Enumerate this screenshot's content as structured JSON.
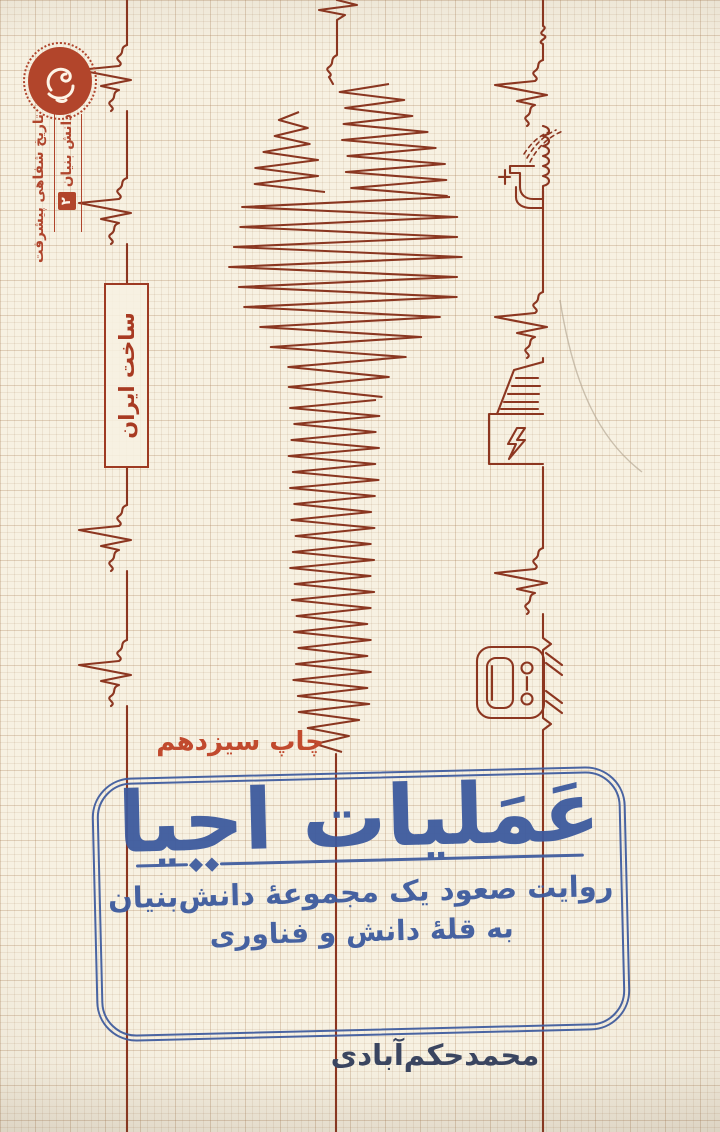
{
  "cover": {
    "series_badge": {
      "line1": "تاریخ شفاهی پیشرفت",
      "line2": "دانش بنیان",
      "number": "۲"
    },
    "made_in_box": "ساخت ایران",
    "edition": "چاپ سیزدهم",
    "stamp": {
      "title": "عَمَلیات احیا",
      "subtitle_line1": "روایت صعود یک مجموعهٔ دانش‌بنیان",
      "subtitle_line2": "به قلهٔ دانش و فناوری"
    },
    "author": "محمدحکم‌آبادی",
    "icons": {
      "publisher_logo": "publisher-calligraphy-logo",
      "line_doodles": [
        "faucet-icon",
        "power-plant-icon",
        "washing-machine-icon"
      ],
      "center_art": "wrench-scribble"
    },
    "colors": {
      "paper": "#f7f1e2",
      "ink_red": "#8c3620",
      "accent_red": "#b2452b",
      "stamp_blue": "#3c5a9e",
      "author_navy": "#3a4560"
    }
  }
}
